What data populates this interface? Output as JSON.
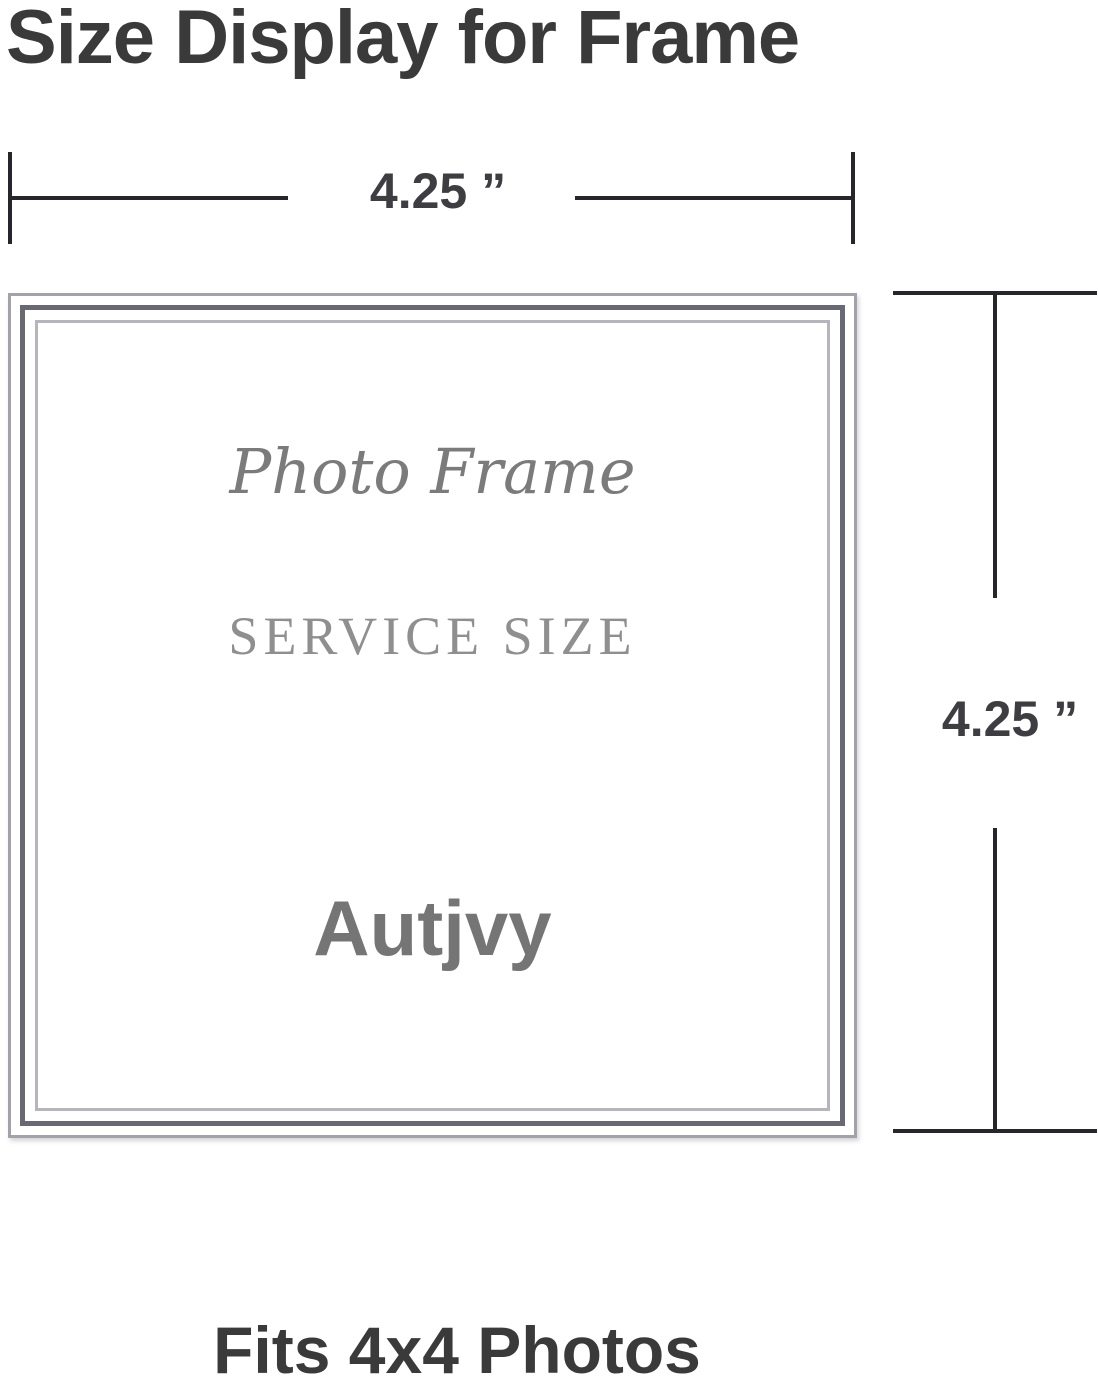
{
  "title": "Size Display for Frame",
  "top_dimension": {
    "label": "4.25 ”"
  },
  "right_dimension": {
    "label": "4.25 ”"
  },
  "frame": {
    "script_text": "Photo Frame",
    "service_text": "SERVICE SIZE",
    "brand_text": "Autjvy"
  },
  "caption": "Fits 4x4 Photos",
  "colors": {
    "background": "#ffffff",
    "title_text": "#3a3a3a",
    "dimension_line": "#26262c",
    "dimension_label": "#3d3d42",
    "frame_outer_line": "#a2a2aa",
    "frame_dark_line": "#696973",
    "frame_inner_line": "#b5b5bd",
    "script_text": "#7b7b7b",
    "service_text": "#8f8f8f",
    "brand_text": "#757575",
    "caption_text": "#3a3a3a"
  }
}
